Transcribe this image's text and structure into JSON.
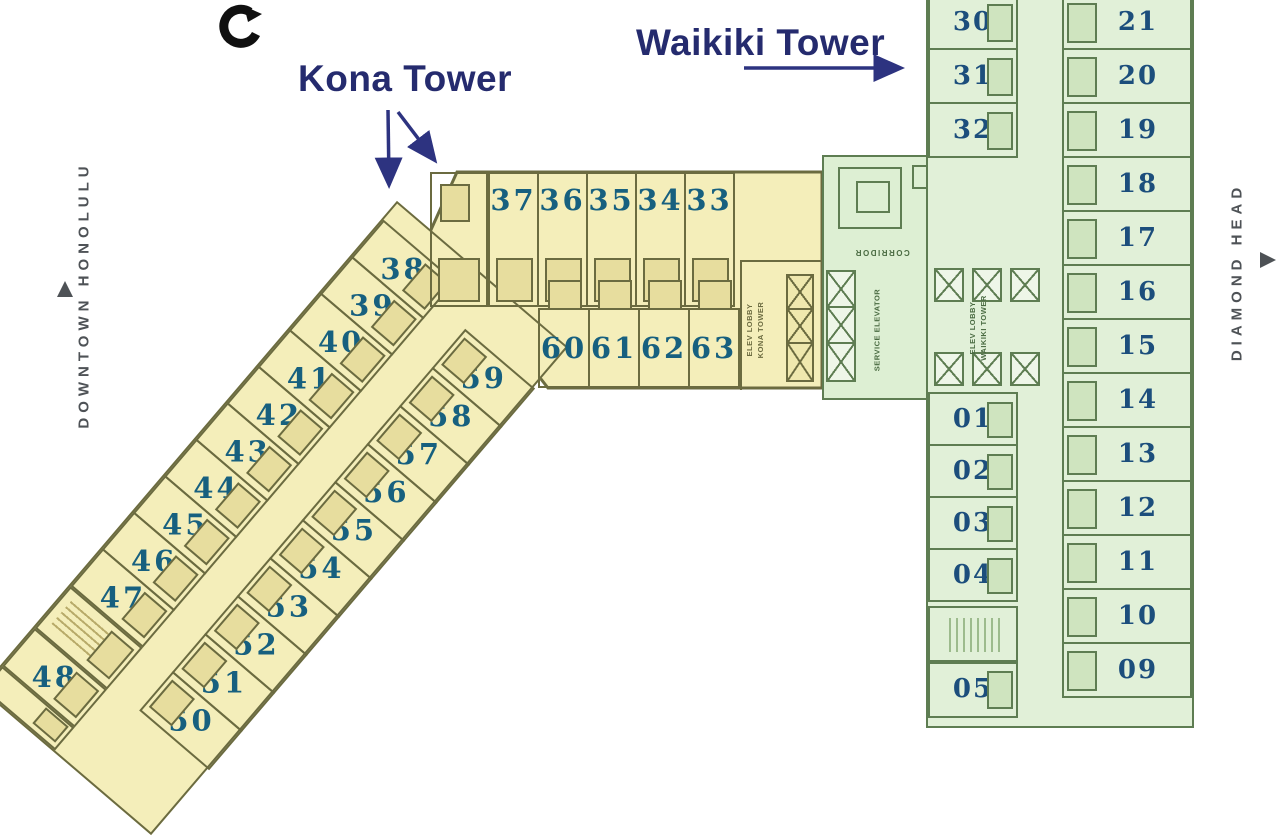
{
  "titles": {
    "kona": "Kona Tower",
    "waikiki": "Waikiki Tower"
  },
  "side_labels": {
    "left": "DOWNTOWN HONOLULU",
    "right": "DIAMOND HEAD"
  },
  "core_labels": {
    "corridor": "CORRIDOR",
    "service_elevator": "SERVICE ELEVATOR",
    "elev_lobby_kona": "ELEV LOBBY\nKONA TOWER",
    "elev_lobby_waikiki": "ELEV LOBBY\nWAIKIKI TOWER"
  },
  "kona_rooms": {
    "top_row": [
      "37",
      "36",
      "35",
      "34",
      "33"
    ],
    "mid_row": [
      "60",
      "61",
      "62",
      "63"
    ],
    "diag_outer_end": [
      "48"
    ],
    "diag_outer": [
      "47",
      "46",
      "45",
      "44",
      "43",
      "42",
      "41",
      "40",
      "39",
      "38"
    ],
    "diag_inner": [
      "50",
      "51",
      "52",
      "53",
      "54",
      "55",
      "56",
      "57",
      "58",
      "59"
    ]
  },
  "waikiki_rooms": {
    "left_top": [
      "30",
      "31",
      "32"
    ],
    "left_mid": [
      "01",
      "02",
      "03",
      "04"
    ],
    "left_bottom": [
      "05"
    ],
    "right": [
      "21",
      "20",
      "19",
      "18",
      "17",
      "16",
      "15",
      "14",
      "13",
      "12",
      "11",
      "10",
      "09"
    ]
  },
  "colors": {
    "kona_fill": "#f4eeba",
    "kona_wall": "#6b6b40",
    "kona_number": "#17607f",
    "waikiki_fill": "#e1f0d8",
    "waikiki_wall": "#5e7d52",
    "waikiki_number": "#1c4e7c",
    "title_navy": "#252b6e",
    "side_label_gray": "#4e5256"
  }
}
